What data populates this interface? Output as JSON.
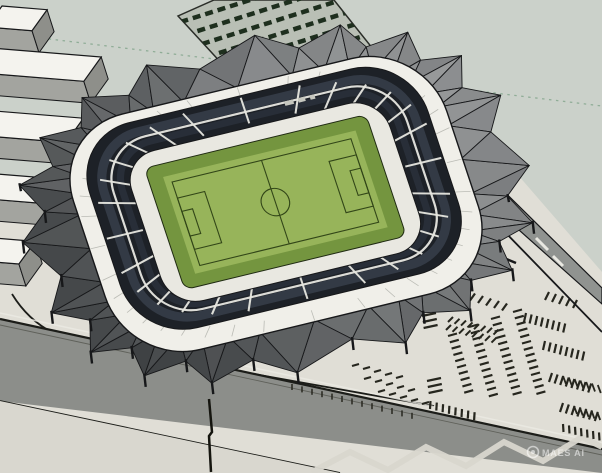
{
  "scene": {
    "description": "3D architectural model render of a football stadium with faceted roof, surrounding plaza, road and parking lots"
  },
  "watermark": {
    "icon": "circle-logo",
    "text": "MAES AI"
  },
  "colors": {
    "bg_sage": "#cbd1ca",
    "plaza": "#e0ded6",
    "road": "#8c8e8a",
    "road_edge": "#1c1d19",
    "curb": "#ecebe4",
    "light_tri": "#d9d7cf",
    "roof_light": "#9a9c9d",
    "roof_dark": "#3f4244",
    "edge_dark": "#17181a",
    "ring_white": "#f0efe9",
    "seam": "#b6b7b0",
    "stands_dark": "#1d2127",
    "stands_tint1": "#39414e",
    "stands_tint2": "#2e3540",
    "aisle": "#e7e7e0",
    "concourse": "#e9e8e1",
    "pitch_border": "#74953f",
    "pitch_field": "#97b45a",
    "pitch_line": "#324618",
    "trees_ground": "#b9bfb5",
    "trees_stripe": "#1e2f1e",
    "bldg_top": "#f4f3ee",
    "bldg_side": "#a3a49f",
    "bldg_end": "#8e8f8a",
    "dotted": "#86a78f",
    "tick": "#26261e",
    "ramp": "#909390",
    "light_zigzag": "#d8d6ce",
    "pole": "#15150f",
    "wm": "rgba(255,255,255,0.55)"
  }
}
